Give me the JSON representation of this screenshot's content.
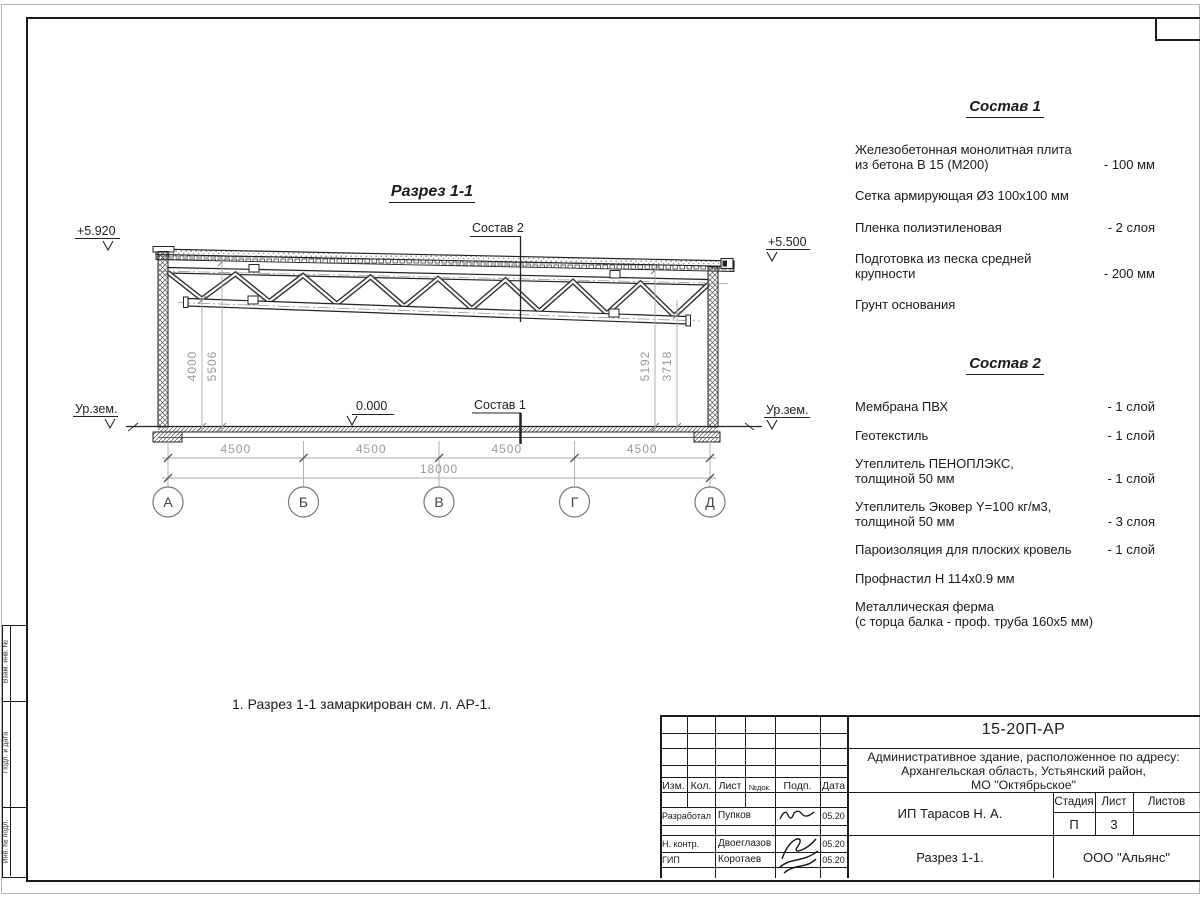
{
  "colors": {
    "ink": "#1a1a1a",
    "dim_gray": "#999999"
  },
  "drawing": {
    "title": "Разрез 1-1",
    "elevation_left": "+5.920",
    "elevation_right": "+5.500",
    "ground_left": "Ур.зем.",
    "ground_right": "Ур.зем.",
    "zero_level": "0.000",
    "leader_top": "Состав 2",
    "leader_floor": "Состав 1",
    "axes": [
      "А",
      "Б",
      "В",
      "Г",
      "Д"
    ],
    "dims": {
      "spans": [
        "4500",
        "4500",
        "4500",
        "4500"
      ],
      "total": "18000",
      "left": [
        "4000",
        "5506"
      ],
      "right": [
        "5192",
        "3718"
      ]
    }
  },
  "sostav1": {
    "title": "Состав 1",
    "items": [
      {
        "lines": [
          "Железобетонная  монолитная плита",
          "из бетона В 15 (М200)"
        ],
        "value": "- 100 мм"
      },
      {
        "lines": [
          "Сетка армирующая Ø3 100х100 мм"
        ],
        "value": ""
      },
      {
        "lines": [
          "Пленка полиэтиленовая"
        ],
        "value": "-  2 слоя"
      },
      {
        "lines": [
          "Подготовка из песка средней",
          "крупности"
        ],
        "value": "- 200 мм"
      },
      {
        "lines": [
          "Грунт основания"
        ],
        "value": ""
      }
    ]
  },
  "sostav2": {
    "title": "Состав 2",
    "items": [
      {
        "lines": [
          "Мембрана ПВХ"
        ],
        "value": "- 1 слой"
      },
      {
        "lines": [
          "Геотекстиль"
        ],
        "value": "- 1 слой"
      },
      {
        "lines": [
          "Утеплитель ПЕНОПЛЭКС,",
          "толщиной 50 мм"
        ],
        "value": "- 1 слой"
      },
      {
        "lines": [
          "Утеплитель Эковер Y=100 кг/м3,",
          "толщиной 50 мм"
        ],
        "value": "- 3 слоя"
      },
      {
        "lines": [
          "Пароизоляция для плоских кровель"
        ],
        "value": "- 1 слой"
      },
      {
        "lines": [
          "Профнастил Н 114х0.9 мм"
        ],
        "value": ""
      },
      {
        "lines": [
          "Металлическая ферма",
          "(с торца балка - проф. труба 160х5 мм)"
        ],
        "value": ""
      }
    ]
  },
  "note": "1. Разрез 1-1 замаркирован см. л. АР-1.",
  "side_stamp": {
    "labels": [
      "Взам. инв. №",
      "Подп. и дата",
      "Инв. № подл."
    ]
  },
  "title_block": {
    "doc_number": "15-20П-АР",
    "project_lines": [
      "Административное здание, расположенное по адресу:",
      "Архангельская область, Устьянский район,",
      "МО \"Октябрьское\""
    ],
    "header_cols": [
      "Изм.",
      "Кол.",
      "Лист",
      "№док.",
      "Подп.",
      "Дата"
    ],
    "rows": [
      {
        "role": "Разработал",
        "name": "Пупков",
        "date": "05.20"
      },
      {
        "role": "Н. контр.",
        "name": "Двоеглазов",
        "date": "05.20"
      },
      {
        "role": "ГИП",
        "name": "Коротаев",
        "date": "05.20"
      }
    ],
    "client": "ИП Тарасов Н. А.",
    "stage_cols": [
      "Стадия",
      "Лист",
      "Листов"
    ],
    "stage": "П",
    "sheet_no": "3",
    "sheet_title": "Разрез 1-1.",
    "company": "ООО \"Альянс\""
  }
}
